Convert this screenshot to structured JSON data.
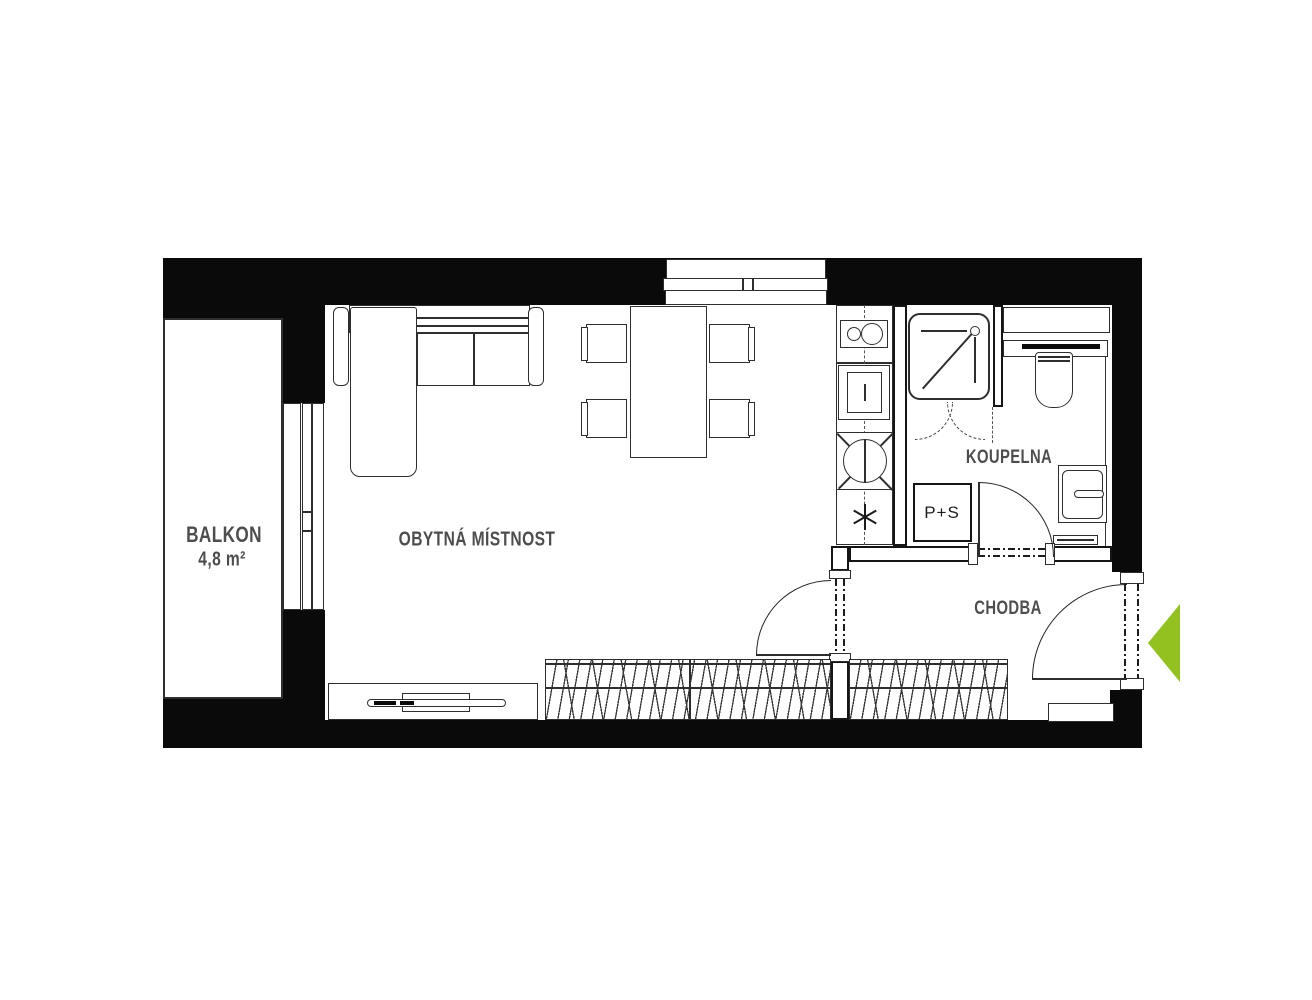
{
  "floorplan": {
    "rooms": {
      "balcony": {
        "name": "BALKON",
        "area": "4,8 m²"
      },
      "living_room": {
        "name": "OBYTNÁ MÍSTNOST"
      },
      "bathroom": {
        "name": "KOUPELNA"
      },
      "hallway": {
        "name": "CHODBA"
      }
    },
    "labels": {
      "washer_dryer": "P+S"
    },
    "colors": {
      "walls": "#0a0a0a",
      "furniture_lines": "#2e2e2e",
      "label_text": "#4d4d4d",
      "entrance_arrow_green": "#92c120"
    },
    "icons": {
      "entrance_arrow": "left-pointing-triangle",
      "boiler_symbol": "six-spoke-asterisk"
    }
  }
}
